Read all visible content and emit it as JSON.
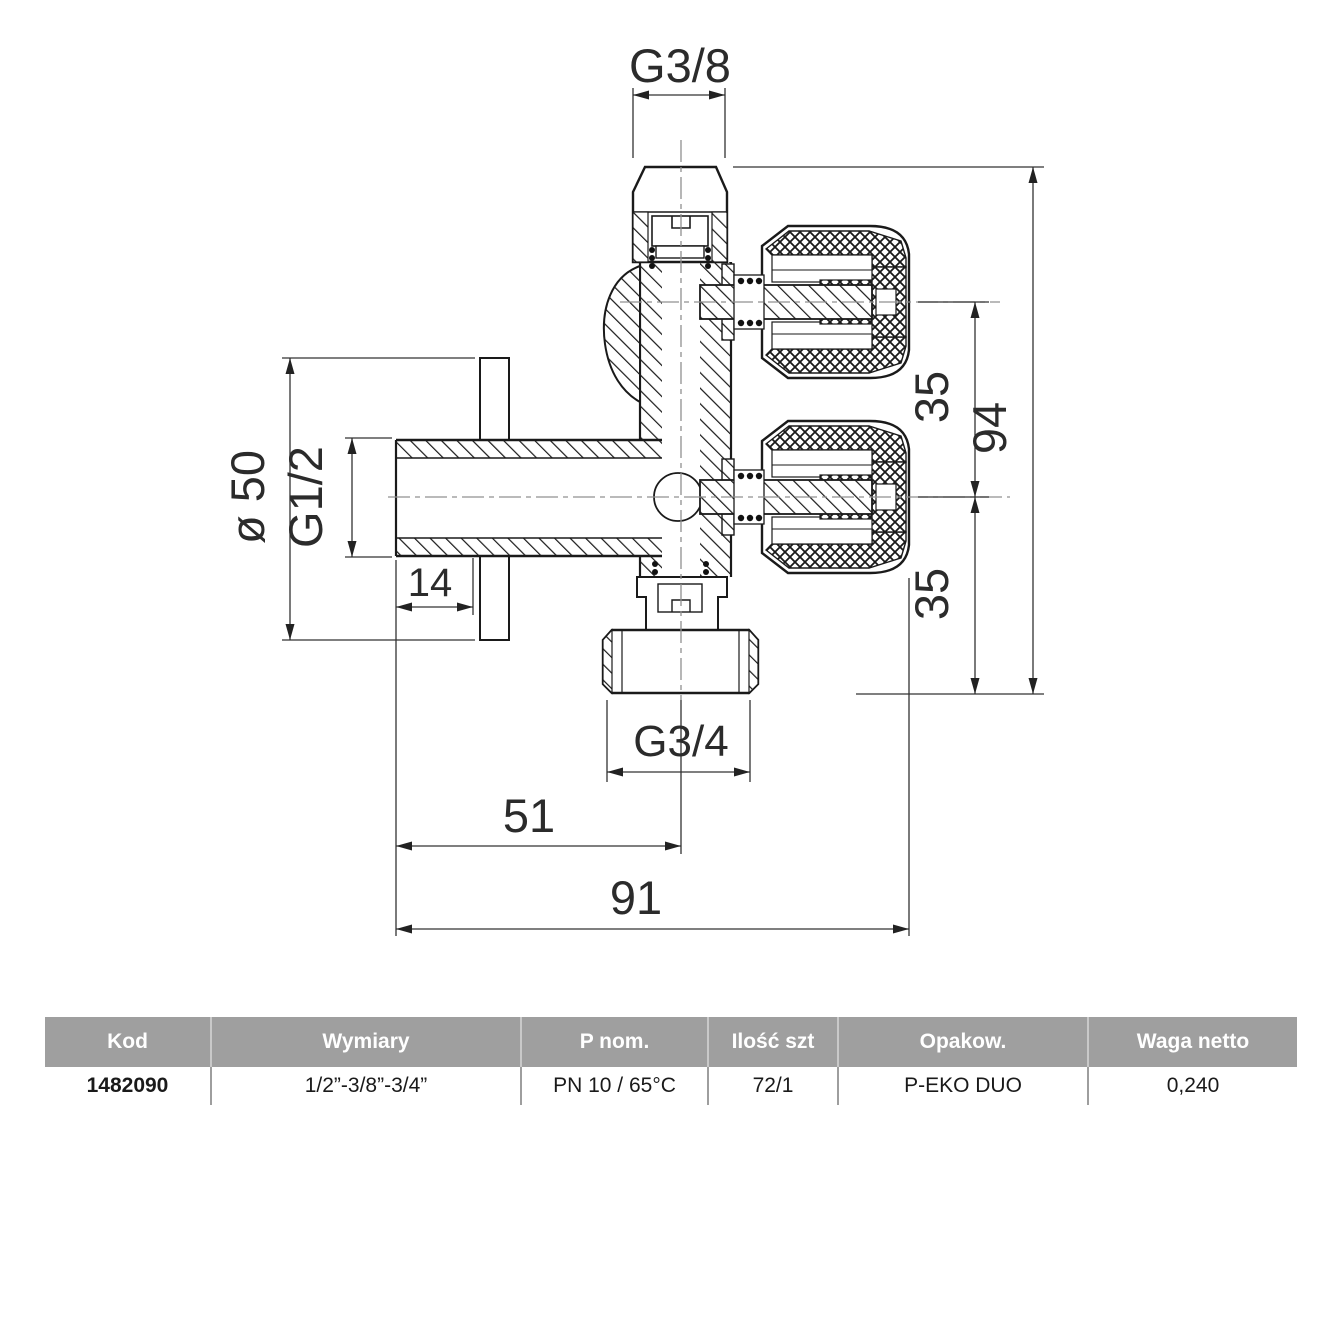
{
  "drawing": {
    "dims": {
      "top_thread": "G3/8",
      "plate_diameter": "ø 50",
      "inlet_thread": "G1/2",
      "plate_offset": "14",
      "outlet_spacing_top": "35",
      "outlet_spacing_bottom": "35",
      "total_height": "94",
      "bottom_thread": "G3/4",
      "center_offset": "51",
      "total_width": "91"
    }
  },
  "table": {
    "headers": [
      "Kod",
      "Wymiary",
      "P nom.",
      "Ilość szt",
      "Opakow.",
      "Waga netto"
    ],
    "row": [
      "1482090",
      "1/2”-3/8”-3/4”",
      "PN 10 / 65°C",
      "72/1",
      "P-EKO DUO",
      "0,240"
    ]
  },
  "colors": {
    "line": "#1a1a1a",
    "dim_line": "#333333",
    "centerline": "#909090",
    "header_bg": "#9f9f9f",
    "header_text": "#ffffff"
  }
}
